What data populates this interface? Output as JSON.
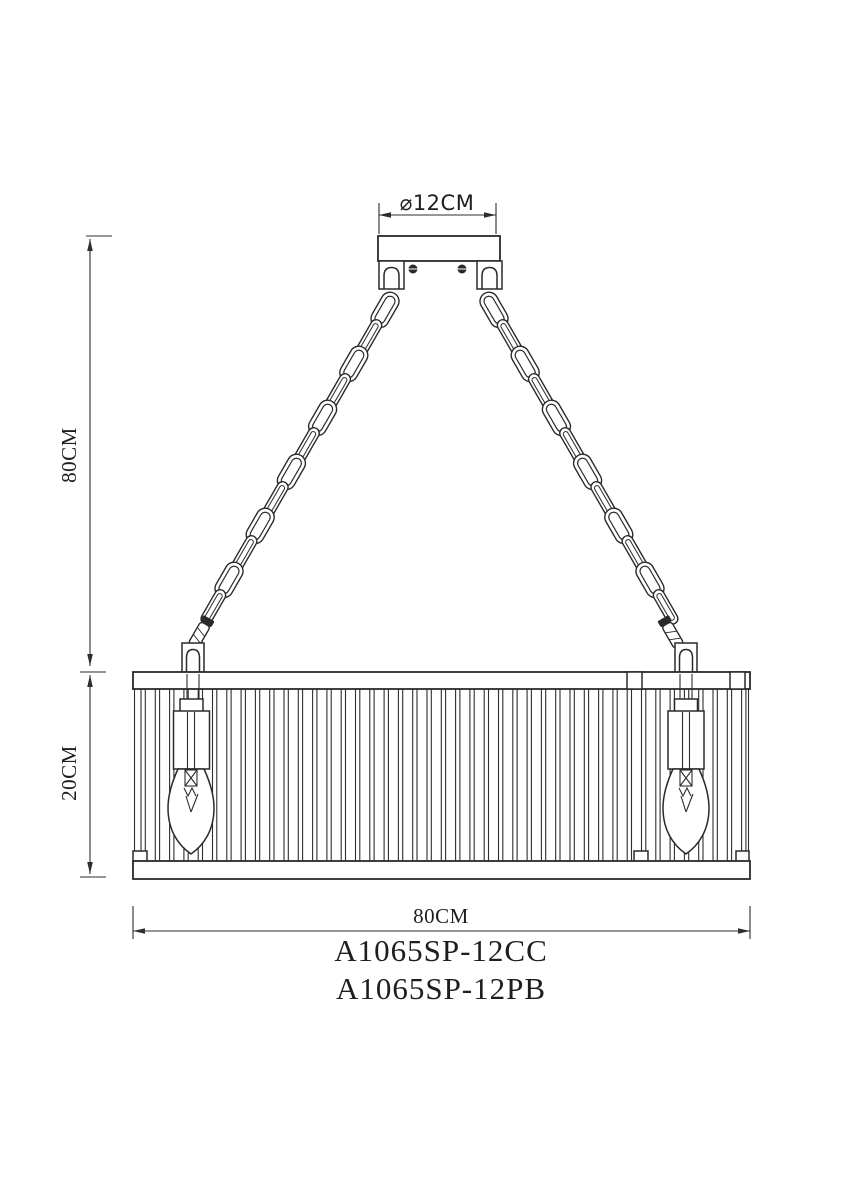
{
  "colors": {
    "line": "#2a2a2a",
    "background": "#ffffff",
    "text": "#1e1e1e"
  },
  "dimensions": {
    "canopy_diameter": "⌀12CM",
    "suspension_height": "80CM",
    "shade_height": "20CM",
    "shade_width": "80CM"
  },
  "models": [
    "A1065SP-12CC",
    "A1065SP-12PB"
  ]
}
